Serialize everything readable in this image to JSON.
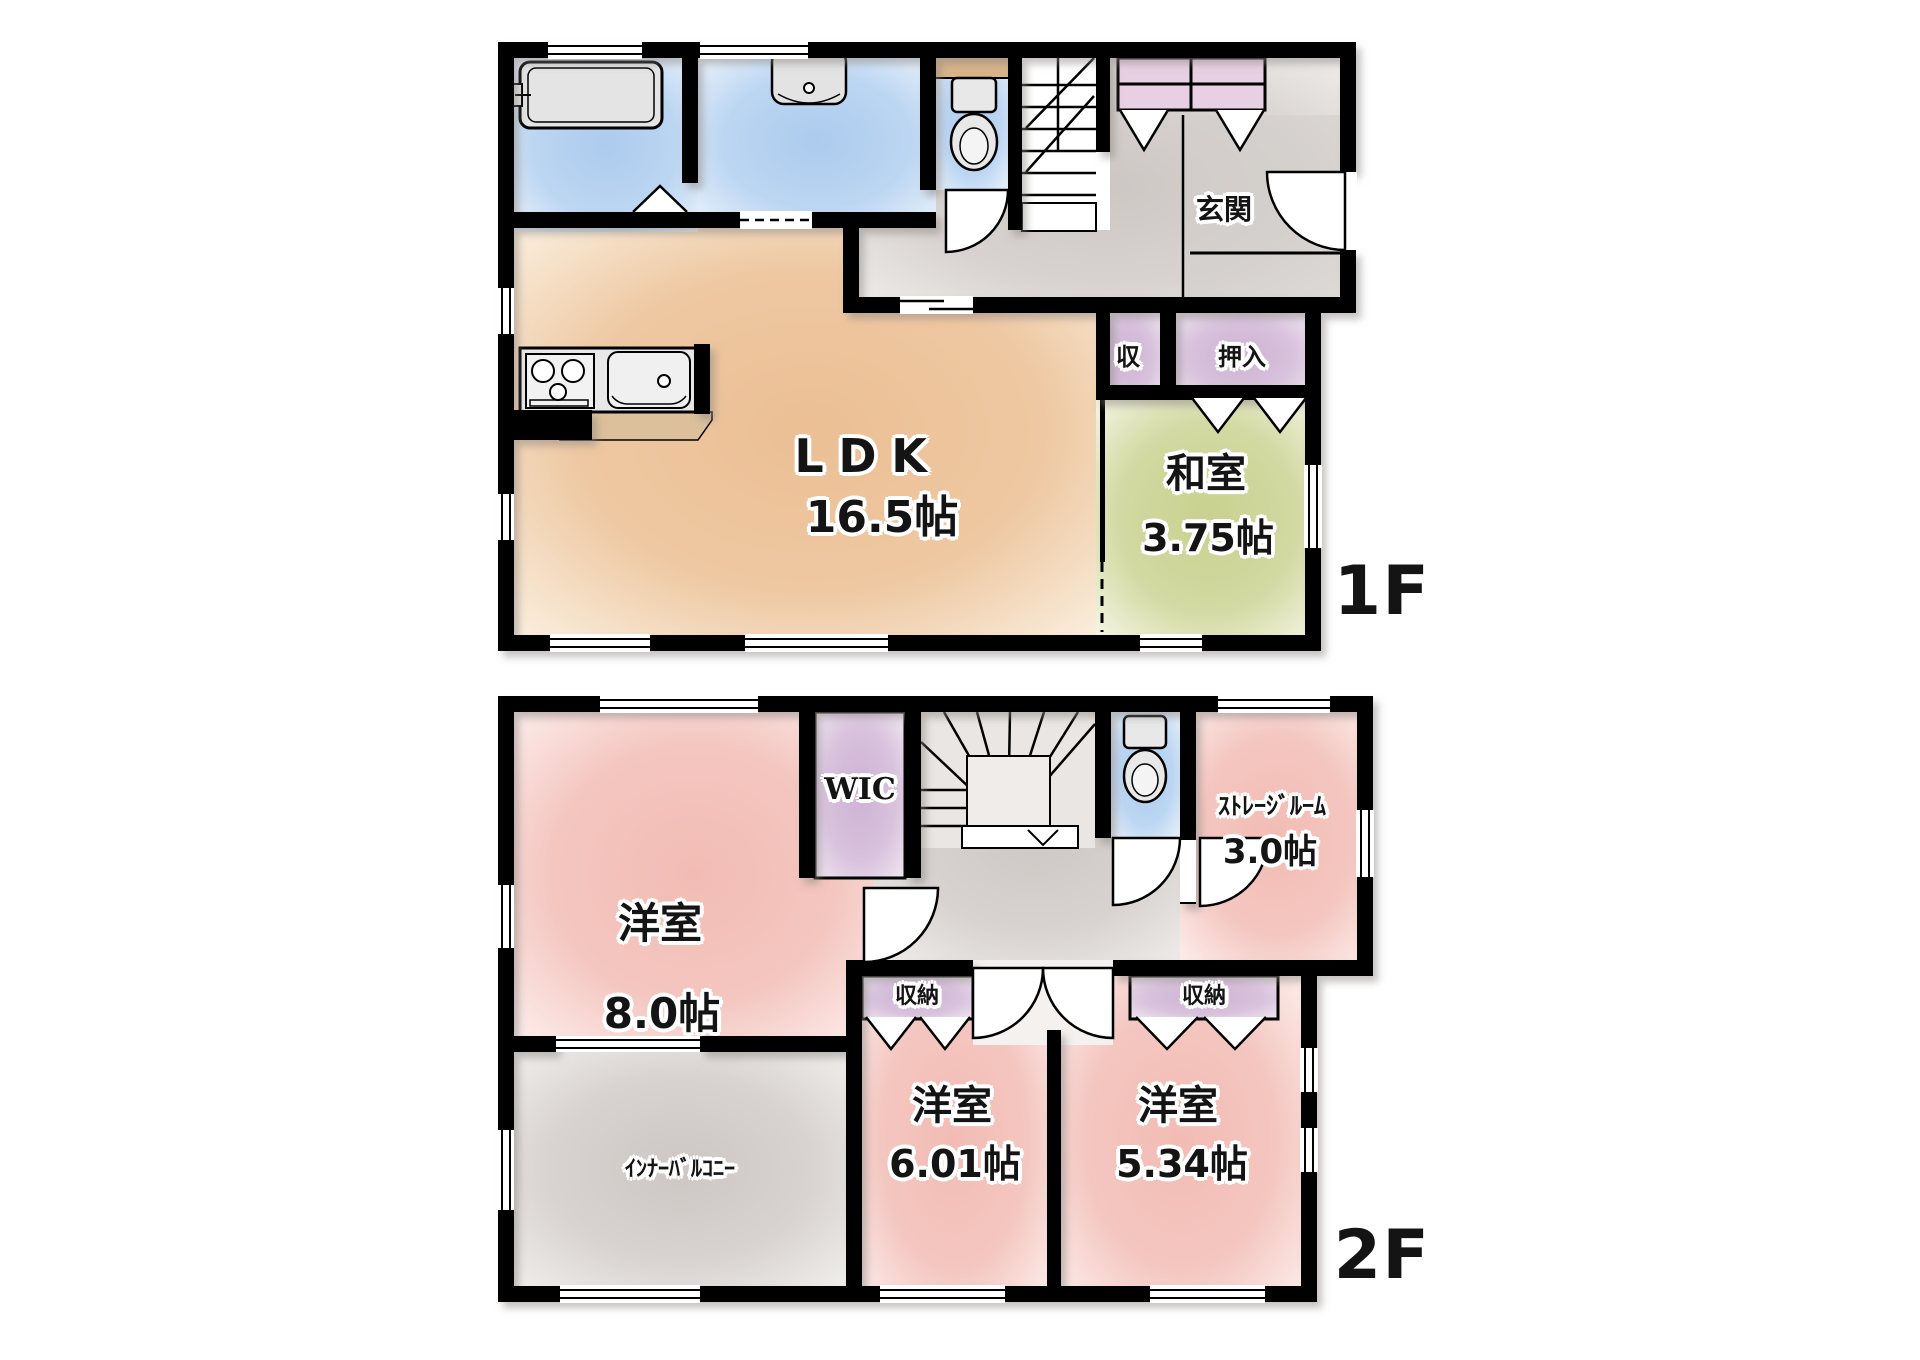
{
  "floors": {
    "f1": {
      "label": "1F",
      "ldk": {
        "name": "LDK",
        "size": "16.5帖"
      },
      "washitsu": {
        "name": "和室",
        "size": "3.75帖"
      },
      "genkan": {
        "name": "玄関"
      },
      "closet_shu": {
        "name": "収"
      },
      "oshiire": {
        "name": "押入"
      }
    },
    "f2": {
      "label": "2F",
      "bedroom8": {
        "name": "洋室",
        "size": "8.0帖"
      },
      "wic": {
        "name": "WIC"
      },
      "storage": {
        "name": "ｽﾄﾚｰｼﾞﾙｰﾑ",
        "size": "3.0帖"
      },
      "closet_left": {
        "name": "収納"
      },
      "closet_right": {
        "name": "収納"
      },
      "bedroom601": {
        "name": "洋室",
        "size": "6.01帖"
      },
      "bedroom534": {
        "name": "洋室",
        "size": "5.34帖"
      },
      "balcony": {
        "name": "ｲﾝﾅｰﾊﾞﾙｺﾆｰ"
      }
    },
    "colors": {
      "wall": "#000000",
      "ldk": "#ecbf94",
      "tatami": "#c9d18f",
      "bedroom": "#f2bcb4",
      "water": "#accbee",
      "closet": "#ceb2d4",
      "hall": "#cdc7c4",
      "counter_top": "#dcc09c"
    }
  }
}
